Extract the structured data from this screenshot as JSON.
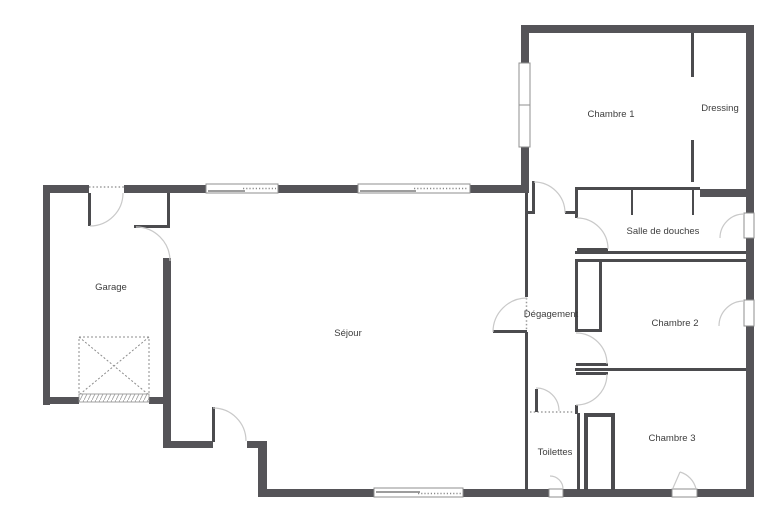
{
  "plan": {
    "type": "floor-plan",
    "colors": {
      "exterior_wall": "#555458",
      "interior_wall": "#4b4b4e",
      "door_arc": "#c9c9c9",
      "label_text": "#3d3d3d",
      "background": "#ffffff"
    },
    "rooms": {
      "garage": {
        "label": "Garage"
      },
      "sejour": {
        "label": "Séjour"
      },
      "degagement": {
        "label": "Dégagement"
      },
      "chambre1": {
        "label": "Chambre 1"
      },
      "dressing": {
        "label": "Dressing"
      },
      "salle_de_douches": {
        "label": "Salle de douches"
      },
      "chambre2": {
        "label": "Chambre 2"
      },
      "chambre3": {
        "label": "Chambre 3"
      },
      "toilettes": {
        "label": "Toilettes"
      }
    }
  }
}
